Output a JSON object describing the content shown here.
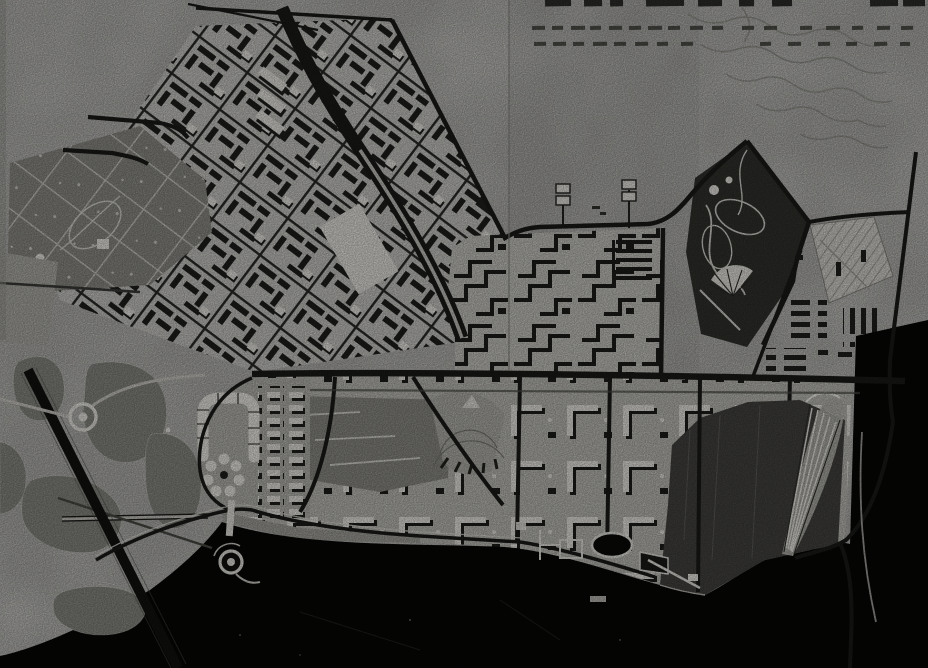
{
  "meta": {
    "kind": "black-and-white aerial photograph of a city master-plan drawing"
  },
  "palette": {
    "paper": "#d7d6d2",
    "paper2": "#c9c8c3",
    "road": "#1b1b19",
    "water": "#070706",
    "island": "#8a8a84",
    "park": "#32322e",
    "white": "#efede7",
    "bank": "#454441",
    "field": "#d9d7d1",
    "parkpath": "#d9d7d1",
    "title_dark": "#2e2e2b",
    "title_light": "#50504b"
  },
  "title_marks": {
    "legible": false,
    "rows": [
      {
        "y": 0,
        "h": 6.5,
        "tone": "title_dark",
        "segments": [
          [
            545,
            26
          ],
          [
            584,
            18
          ],
          [
            610,
            13
          ],
          [
            646,
            38
          ],
          [
            698,
            24
          ],
          [
            739,
            15
          ],
          [
            772,
            20
          ],
          [
            870,
            28
          ],
          [
            903,
            22
          ]
        ]
      },
      {
        "y": 26,
        "h": 4,
        "tone": "title_light",
        "segments": [
          [
            532,
            13
          ],
          [
            552,
            11
          ],
          [
            571,
            14
          ],
          [
            590,
            11
          ],
          [
            609,
            13
          ],
          [
            629,
            12
          ],
          [
            648,
            14
          ],
          [
            668,
            12
          ],
          [
            690,
            13
          ],
          [
            712,
            11
          ],
          [
            742,
            12
          ],
          [
            764,
            13
          ],
          [
            800,
            12
          ],
          [
            826,
            14
          ],
          [
            852,
            11
          ],
          [
            877,
            13
          ],
          [
            901,
            12
          ]
        ]
      },
      {
        "y": 42,
        "h": 4,
        "tone": "title_light",
        "segments": [
          [
            534,
            12
          ],
          [
            553,
            13
          ],
          [
            573,
            11
          ],
          [
            593,
            14
          ],
          [
            614,
            12
          ],
          [
            635,
            13
          ],
          [
            657,
            11
          ],
          [
            681,
            12
          ],
          [
            760,
            11
          ],
          [
            788,
            13
          ],
          [
            818,
            12
          ],
          [
            846,
            11
          ],
          [
            874,
            13
          ],
          [
            900,
            10
          ]
        ]
      }
    ]
  }
}
